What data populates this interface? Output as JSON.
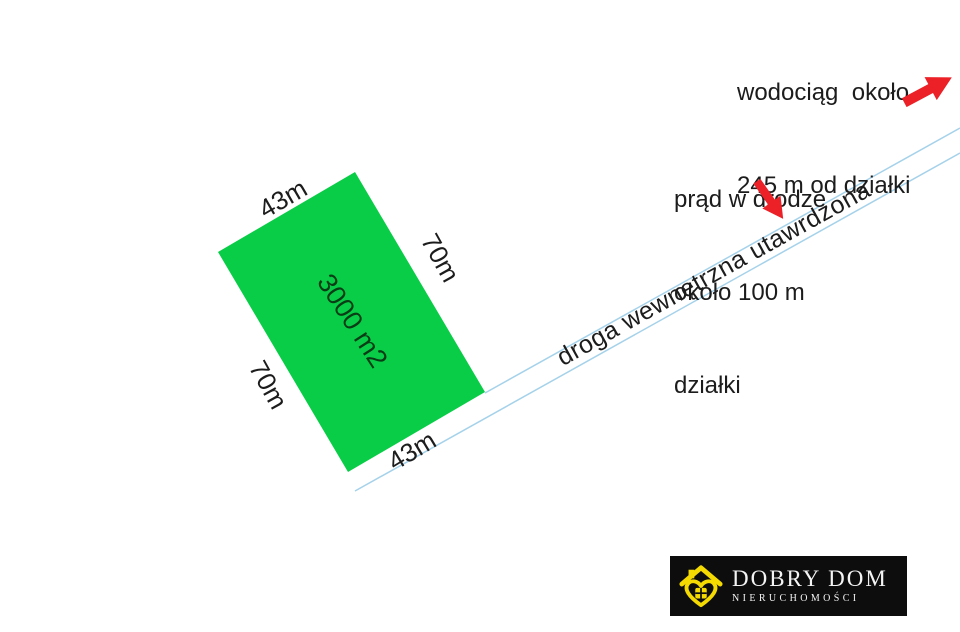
{
  "diagram": {
    "type": "land-plot-offer-diagram"
  },
  "colors": {
    "plot-green": "#09CD46",
    "area-text": "#0A3D16",
    "road-blue": "#A5D2EA",
    "arrow-red": "#EB2127",
    "text-dark": "#1C1C1C",
    "logo-bg": "#0D0D0D",
    "logo-yellow": "#F4DA00",
    "logo-text": "#F4F4F4"
  },
  "parcel": {
    "area_label": "3000 m2",
    "side_top_label": "43m",
    "side_right_label": "70m",
    "side_bottom_label": "43m",
    "side_left_label": "70m"
  },
  "road": {
    "label": "droga wewnętrzna utawrdzona"
  },
  "annotations": {
    "water": {
      "line1": "wodociąg  około",
      "line2": "245 m od działki",
      "icon": "red-arrow-up-right"
    },
    "power": {
      "line1": "prąd w drodze",
      "line2": "około 100 m",
      "line3": "działki",
      "icon": "red-arrow-down-right"
    }
  },
  "logo": {
    "name": "DOBRY DOM",
    "subtitle": "NIERUCHOMOŚCI",
    "icon": "house-heart-icon"
  }
}
